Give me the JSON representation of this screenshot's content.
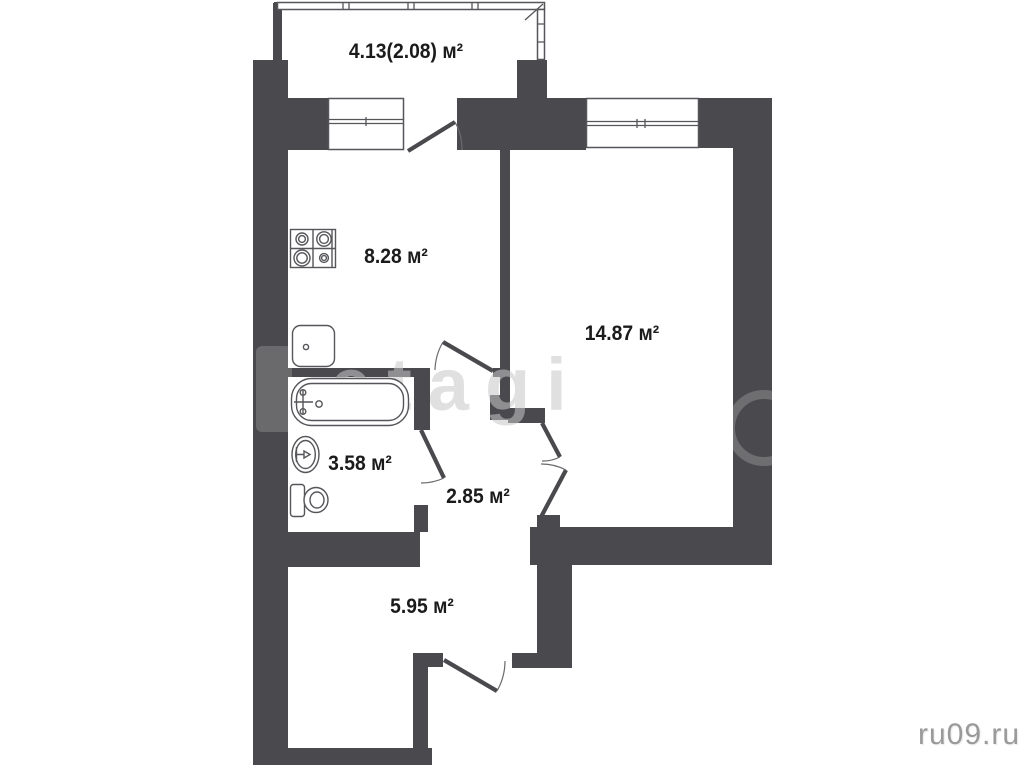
{
  "plan": {
    "type": "apartment-floor-plan",
    "units": "м²"
  },
  "rooms": {
    "balcony": {
      "area_label": "4.13(2.08) м²"
    },
    "kitchen": {
      "area_label": "8.28 м²"
    },
    "living_room": {
      "area_label": "14.87 м²"
    },
    "bathroom": {
      "area_label": "3.58 м²"
    },
    "hallway": {
      "area_label": "2.85 м²"
    },
    "corridor": {
      "area_label": "5.95 м²"
    }
  },
  "fixtures": {
    "stove": "stove-icon",
    "kitchen_sink": "kitchen-sink-icon",
    "bathtub": "bathtub-icon",
    "washbasin": "washbasin-icon",
    "toilet": "toilet-icon"
  },
  "watermarks": {
    "agency": "etagi",
    "site": "ru09.ru"
  },
  "colors": {
    "wall": "#4a4a4e",
    "line": "#55555a",
    "text": "#1b1b1b",
    "watermark": "#c8c8c8",
    "watermark_site": "#9a9a9a"
  }
}
